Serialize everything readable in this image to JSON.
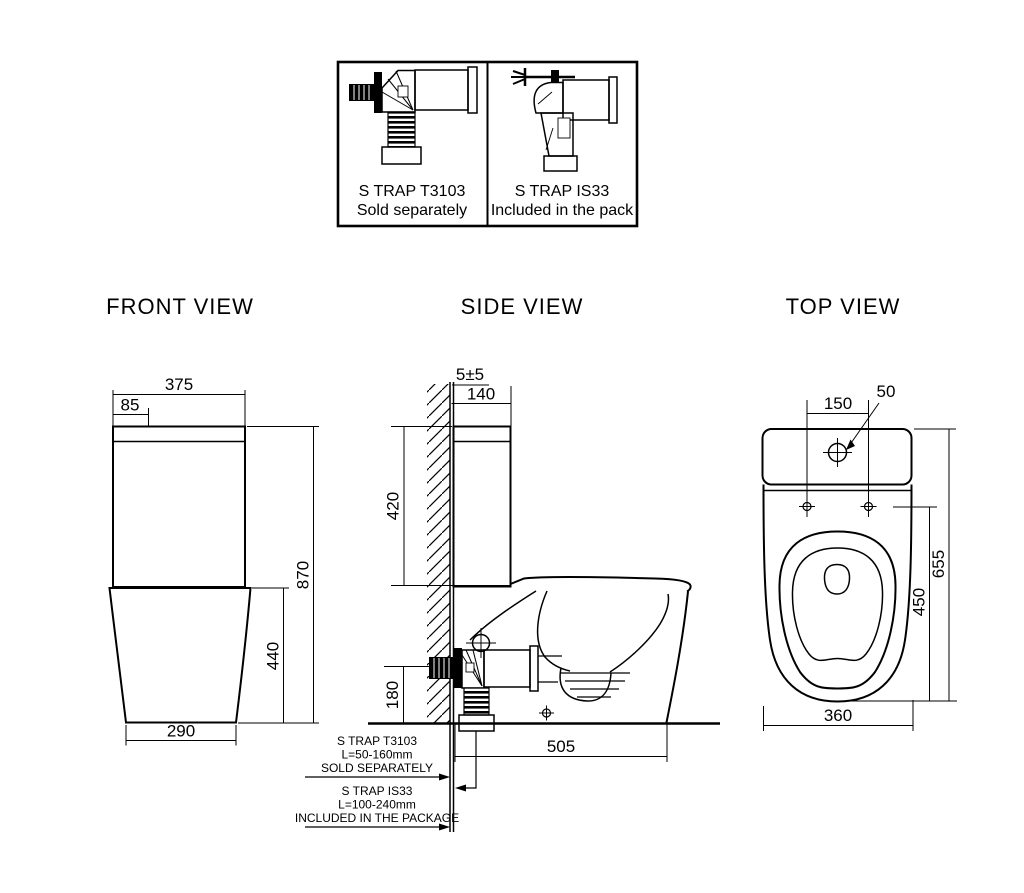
{
  "page": {
    "background": "#ffffff",
    "line_color": "#000000"
  },
  "titles": {
    "front": "FRONT VIEW",
    "side": "SIDE VIEW",
    "top": "TOP VIEW"
  },
  "trap_box": {
    "left": {
      "title": "S TRAP T3103",
      "subtitle": "Sold separately"
    },
    "right": {
      "title": "S TRAP IS33",
      "subtitle": "Included in the pack"
    }
  },
  "front_dims": {
    "width": "375",
    "lid_offset": "85",
    "height": "870",
    "base_height": "440",
    "base_width": "290"
  },
  "side_dims": {
    "wall_gap": "5±5",
    "tank_depth": "140",
    "tank_height": "420",
    "outlet_height": "180",
    "floor_depth": "505"
  },
  "side_annotations": {
    "t3103": {
      "line1": "S TRAP T3103",
      "line2": "L=50-160mm",
      "line3": "SOLD SEPARATELY"
    },
    "is33": {
      "line1": "S TRAP IS33",
      "line2": "L=100-240mm",
      "line3": "INCLUDED IN THE PACKAGE"
    }
  },
  "top_dims": {
    "hole_spacing": "150",
    "hole_diameter": "50",
    "total_depth": "655",
    "bowl_depth": "450",
    "width": "360"
  }
}
